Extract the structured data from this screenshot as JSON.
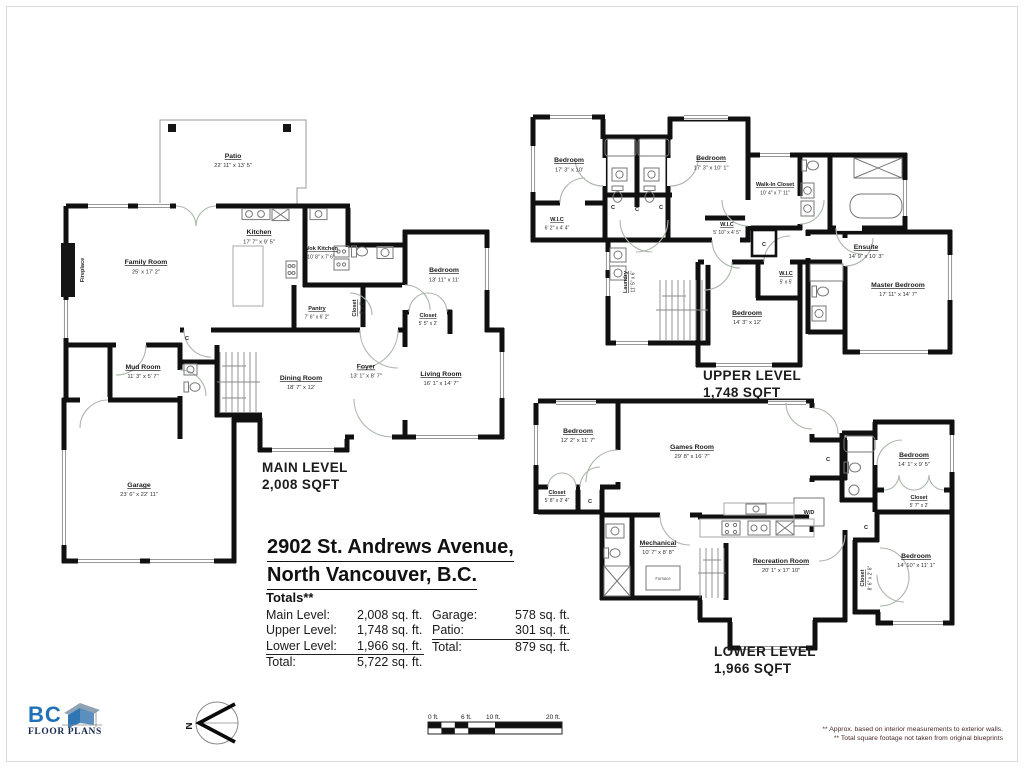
{
  "address": {
    "line1": "2902 St. Andrews Avenue,",
    "line2": "North Vancouver, B.C."
  },
  "totals": {
    "heading": "Totals**",
    "col1": [
      {
        "label": "Main Level:",
        "value": "2,008 sq. ft."
      },
      {
        "label": "Upper Level:",
        "value": "1,748 sq. ft."
      },
      {
        "label": "Lower Level:",
        "value": "1,966 sq. ft."
      },
      {
        "label": "Total:",
        "value": "5,722 sq. ft."
      }
    ],
    "col2": [
      {
        "label": "Garage:",
        "value": "578 sq. ft."
      },
      {
        "label": "Patio:",
        "value": "301 sq. ft."
      },
      {
        "label": "Total:",
        "value": "879 sq. ft."
      }
    ]
  },
  "levels": {
    "main": {
      "title": "MAIN LEVEL",
      "sqft": "2,008 SQFT",
      "rooms": {
        "patio": {
          "name": "Patio",
          "dims": "22' 11\" x 13' 5\""
        },
        "family": {
          "name": "Family Room",
          "dims": "25' x 17' 2\""
        },
        "kitchen": {
          "name": "Kitchen",
          "dims": "17' 7\" x 9' 5\""
        },
        "wok": {
          "name": "Wok Kitchen",
          "dims": "10' 8\" x 7' 6\""
        },
        "pantry": {
          "name": "Pantry",
          "dims": "7' 6\" x 6' 2\""
        },
        "closet_hall": {
          "name": "Closet",
          "dims": "6' x 2'"
        },
        "bedroom": {
          "name": "Bedroom",
          "dims": "13' 11\" x 11'"
        },
        "closet_bed": {
          "name": "Closet",
          "dims": "5' 5\" x 2'"
        },
        "mudroom": {
          "name": "Mud Room",
          "dims": "11' 3\" x 5' 7\""
        },
        "foyer": {
          "name": "Foyer",
          "dims": "13' 1\" x 8' 7\""
        },
        "dining": {
          "name": "Dining Room",
          "dims": "18' 7\" x 12'"
        },
        "living": {
          "name": "Living Room",
          "dims": "16' 1\" x 14' 7\""
        },
        "garage": {
          "name": "Garage",
          "dims": "23' 6\" x 22' 11\""
        }
      }
    },
    "upper": {
      "title": "UPPER LEVEL",
      "sqft": "1,748 SQFT",
      "rooms": {
        "bedroom1": {
          "name": "Bedroom",
          "dims": "17' 3\" x 10'"
        },
        "bedroom2": {
          "name": "Bedroom",
          "dims": "17' 3\" x 10' 1\""
        },
        "wic1": {
          "name": "W.I.C",
          "dims": "6' 2\" x 4' 4\""
        },
        "wic2": {
          "name": "W.I.C",
          "dims": "5' 10\" x 4' 5\""
        },
        "walkin": {
          "name": "Walk-In Closet",
          "dims": "10' 4\" x 7' 11\""
        },
        "ensuite": {
          "name": "Ensuite",
          "dims": "14' 9\" x 10' 3\""
        },
        "laundry": {
          "name": "Laundry",
          "dims": "11' 5\" x 6'"
        },
        "wic3": {
          "name": "W.I.C",
          "dims": "5' x 5'"
        },
        "bedroom3": {
          "name": "Bedroom",
          "dims": "14' 3\" x 12'"
        },
        "master": {
          "name": "Master Bedroom",
          "dims": "17' 11\" x 14' 7\""
        }
      }
    },
    "lower": {
      "title": "LOWER LEVEL",
      "sqft": "1,966 SQFT",
      "rooms": {
        "bedroom1": {
          "name": "Bedroom",
          "dims": "12' 2\" x 11' 7\""
        },
        "games": {
          "name": "Games Room",
          "dims": "29' 8\" x 16' 7\""
        },
        "closet1": {
          "name": "Closet",
          "dims": "5' 8\" x 3' 4\""
        },
        "mechanical": {
          "name": "Mechanical",
          "dims": "10' 7\" x 8' 8\""
        },
        "recreation": {
          "name": "Recreation Room",
          "dims": "20' 1\" x 17' 10\""
        },
        "bedroom2": {
          "name": "Bedroom",
          "dims": "14' 1\" x 9' 5\""
        },
        "closet2": {
          "name": "Closet",
          "dims": "5' 7\" x 2'"
        },
        "bedroom3": {
          "name": "Bedroom",
          "dims": "14' 10\" x 11' 1\""
        },
        "closet3": {
          "name": "Closet",
          "dims": "8' 6\" x 2' 6\""
        }
      }
    }
  },
  "markers": {
    "closet_c": "C",
    "wd": "W/D",
    "furnace": "Furnace",
    "fireplace": "Fireplace"
  },
  "scalebar": {
    "labels": [
      "0 ft.",
      "6 ft.",
      "10 ft.",
      "20 ft."
    ]
  },
  "compass": {
    "north": "N"
  },
  "logo": {
    "bc": "BC",
    "floorplans": "FLOOR PLANS"
  },
  "footnotes": {
    "line1": "** Approx. based on interior measurements to exterior walls.",
    "line2": "** Total square footage not taken from original blueprints"
  }
}
